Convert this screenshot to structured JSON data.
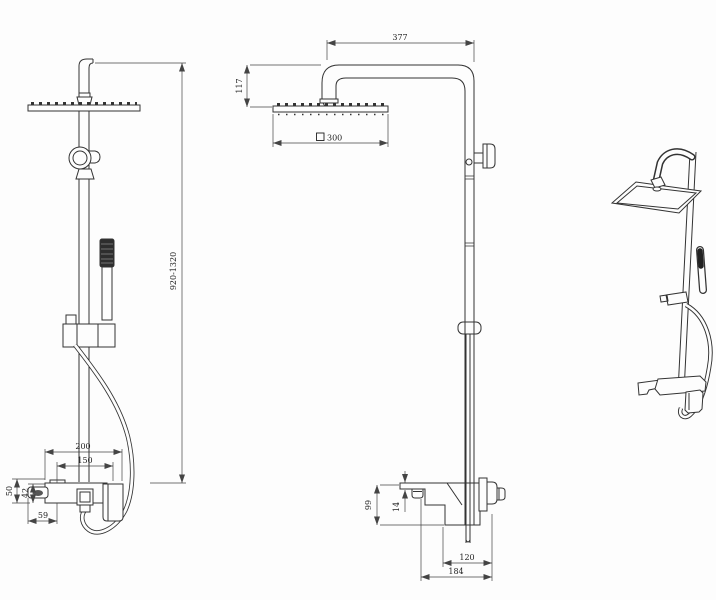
{
  "drawing": {
    "type": "technical-dimension-drawing",
    "subject": "shower column set with square rain head, hand shower and wall mixer",
    "views": [
      "front-view",
      "side-view",
      "perspective-view"
    ]
  },
  "colors": {
    "line": "#333333",
    "dimension_line": "#444444",
    "text": "#1f1f1f",
    "background": "#fdfdfd"
  },
  "dims": {
    "arm_length": "377",
    "head_drop": "117",
    "head_size": "300",
    "head_size_symbol": "square-outline",
    "overall_height": "920-1320",
    "mixer_width": "200",
    "mixer_centers": "150",
    "mixer_total_height": "50",
    "mixer_body_height": "42",
    "mixer_spout_width": "59",
    "mixer_depth": "99",
    "spout_lip_height": "14",
    "wall_offset": "120",
    "spout_reach": "184"
  }
}
